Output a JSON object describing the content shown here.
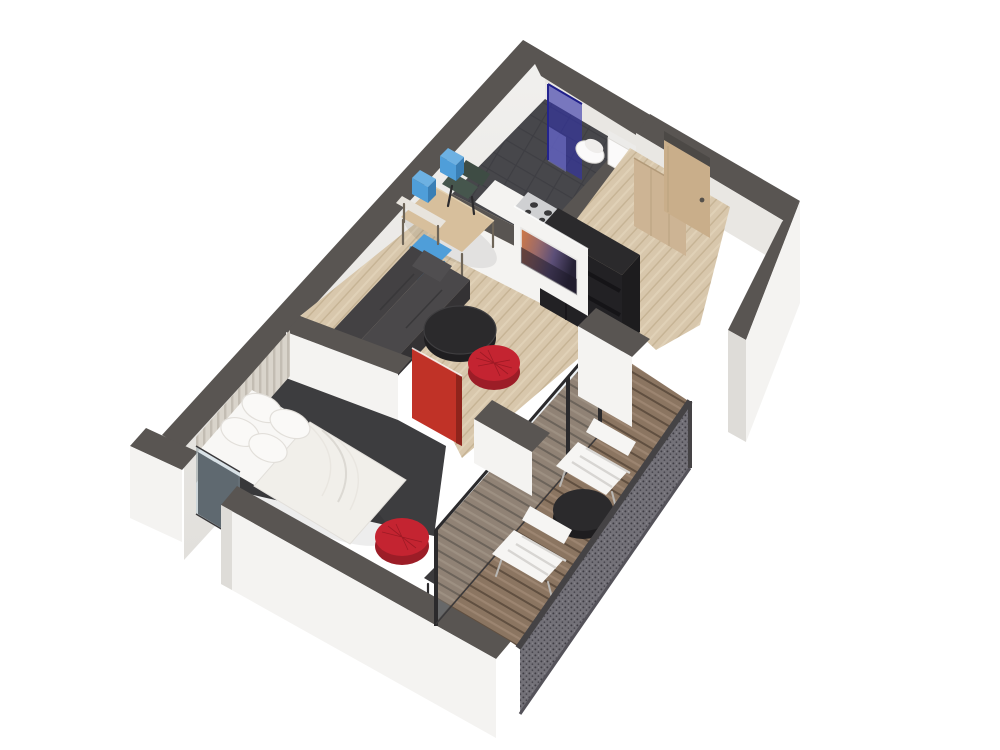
{
  "scene": {
    "name": "apartment-3d-floor-plan-render",
    "type": "isometric dollhouse cutaway floor plan",
    "background": "#ffffff"
  },
  "palette": {
    "wall_top": "#595552",
    "wall_top_dark": "#4c4946",
    "wall_face": "#f4f3f1",
    "wall_face_shade": "#e9e7e3",
    "wall_face_dim": "#dedcd8",
    "wood_floor": "#d8c7ac",
    "wood_streak": "#c6b394",
    "bath_floor": "#47474b",
    "carpet": "#3d3d3f",
    "deck_wood": "#8b7561",
    "deck_gap": "#604f40",
    "sofa_gray": "#4a484a",
    "sofa_top": "#434143",
    "sofa_dark": "#343234",
    "furniture_black": "#2b2a2c",
    "furniture_black_face": "#222124",
    "accent_red": "#c42431",
    "accent_red_dark": "#9c1d27",
    "door_red": "#c03227",
    "accent_blue": "#4f9ed9",
    "accent_blue_dark": "#3a7fb5",
    "shower_blue": "#3232a8",
    "glass_tint": "#a9c3d3",
    "bed_white": "#f8f7f5",
    "duvet_white": "#f1efea",
    "pillow_white": "#faf9f7",
    "slat_wood": "#d9d4cb",
    "slat_gap": "#c3bdb3",
    "table_wood": "#d7bf9c",
    "chair_green": "#3e4c44",
    "door_wood": "#c9ae8a",
    "wardrobe_wood": "#cdb494",
    "mesh_gray": "#737178",
    "mesh_dot": "#3f3d44",
    "white_chair": "#f6f5f3",
    "toilet_white": "#fbfafa"
  },
  "rooms": {
    "bathroom": {
      "name": "Bathroom",
      "floor": "dark tile",
      "items": [
        "glass shower enclosure",
        "toilet",
        "bidet"
      ]
    },
    "entry": {
      "name": "Entry hallway",
      "floor": "light wood",
      "items": [
        "entry door",
        "wardrobe"
      ]
    },
    "living_kitchen": {
      "name": "Living room with kitchenette",
      "floor": "light wood",
      "items": [
        "sofa",
        "coffee table",
        "red ottoman",
        "dining table",
        "green chair",
        "blue chair",
        "blue wall boxes",
        "wall console",
        "tv partition",
        "tv",
        "black kitchen unit",
        "cooktop"
      ]
    },
    "bedroom": {
      "name": "Bedroom",
      "floor": "charcoal carpet",
      "items": [
        "double bed",
        "pillows",
        "slat headboard wall",
        "red sliding door",
        "red ottoman",
        "desk",
        "window"
      ]
    },
    "balcony": {
      "name": "Balcony",
      "floor": "wood deck",
      "items": [
        "glass sliding doors",
        "lounge chair",
        "lounge chair",
        "round table",
        "perforated balustrade"
      ]
    }
  }
}
